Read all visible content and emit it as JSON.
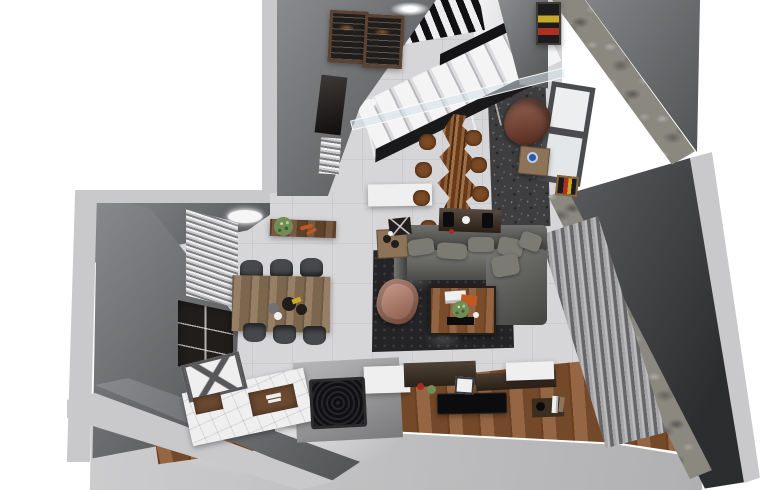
{
  "scene": {
    "title": "top-down-3d-render-apartment-interior",
    "background": "#ffffff",
    "palette": {
      "white_bg": "#ffffff",
      "wall_cut": "#c9c9cb",
      "wall_face": "#6f7174",
      "wall_face_dark": "#4a4b4e",
      "floor_tile": "#d6d6d8",
      "floor_fore": "#c4c4c6",
      "granite": "#3e3e41",
      "stone": "#8b8880",
      "wood_floor": "#8a5731",
      "wood_dark": "#3b2d20",
      "wood_slab": "#7c4a24",
      "wood_table": "#8d7458",
      "counter_white": "#efeff0",
      "counter_gray": "#98989a",
      "sofa": "#565653",
      "cushion": "#7b7b74",
      "rug": "#242325",
      "armchair_salmon": "#bd7b64",
      "leather_brown": "#7e3b26",
      "curtain": "#97979a",
      "cabinet_dark": "#211d1b",
      "chair_dark": "#46484b",
      "plant_green": "#6f8d55",
      "accent_blue": "#2a58a8",
      "accent_red": "#a82a20",
      "accent_orange": "#c05a20",
      "accent_yellow": "#c8a828",
      "tv_black": "#0c0c0e",
      "grill_black": "#141416",
      "frame_wood": "#6b4a30",
      "landing_white": "#e6e6e8",
      "glass": "rgba(213,226,233,0.55)",
      "lamp_white": "#f5f5f6"
    },
    "objects": [
      {
        "name": "staircase",
        "label": "white stairs with dark stringer and glass railing"
      },
      {
        "name": "chalkboard-frames",
        "label": "two framed chalkboards on upper wall"
      },
      {
        "name": "slab-dining-table",
        "label": "live-edge wood slab table with eight stools"
      },
      {
        "name": "dining-table",
        "label": "wooden dining table with six dark chairs"
      },
      {
        "name": "sectional-sofa",
        "label": "gray L-shaped sectional with cushions"
      },
      {
        "name": "shag-rug",
        "label": "dark mottled shag rug"
      },
      {
        "name": "coffee-table",
        "label": "wood coffee table with books and plant"
      },
      {
        "name": "salmon-armchair",
        "label": "salmon lounge chair"
      },
      {
        "name": "leather-armchair",
        "label": "brown leather chair in window nook"
      },
      {
        "name": "curtains",
        "label": "floor-length curtains along right glazing"
      },
      {
        "name": "stone-ledge",
        "label": "stone sill ledge along right wall"
      },
      {
        "name": "kitchen-island",
        "label": "tiled island with sink recess and grill cooktop"
      },
      {
        "name": "tv-panel",
        "label": "black TV on wood floor media zone"
      },
      {
        "name": "wall-cabinet",
        "label": "dark shelving unit on left wall"
      },
      {
        "name": "window-blinds",
        "label": "striped blinds on left window"
      },
      {
        "name": "plant-shelf",
        "label": "wall shelf with green plant"
      }
    ]
  }
}
